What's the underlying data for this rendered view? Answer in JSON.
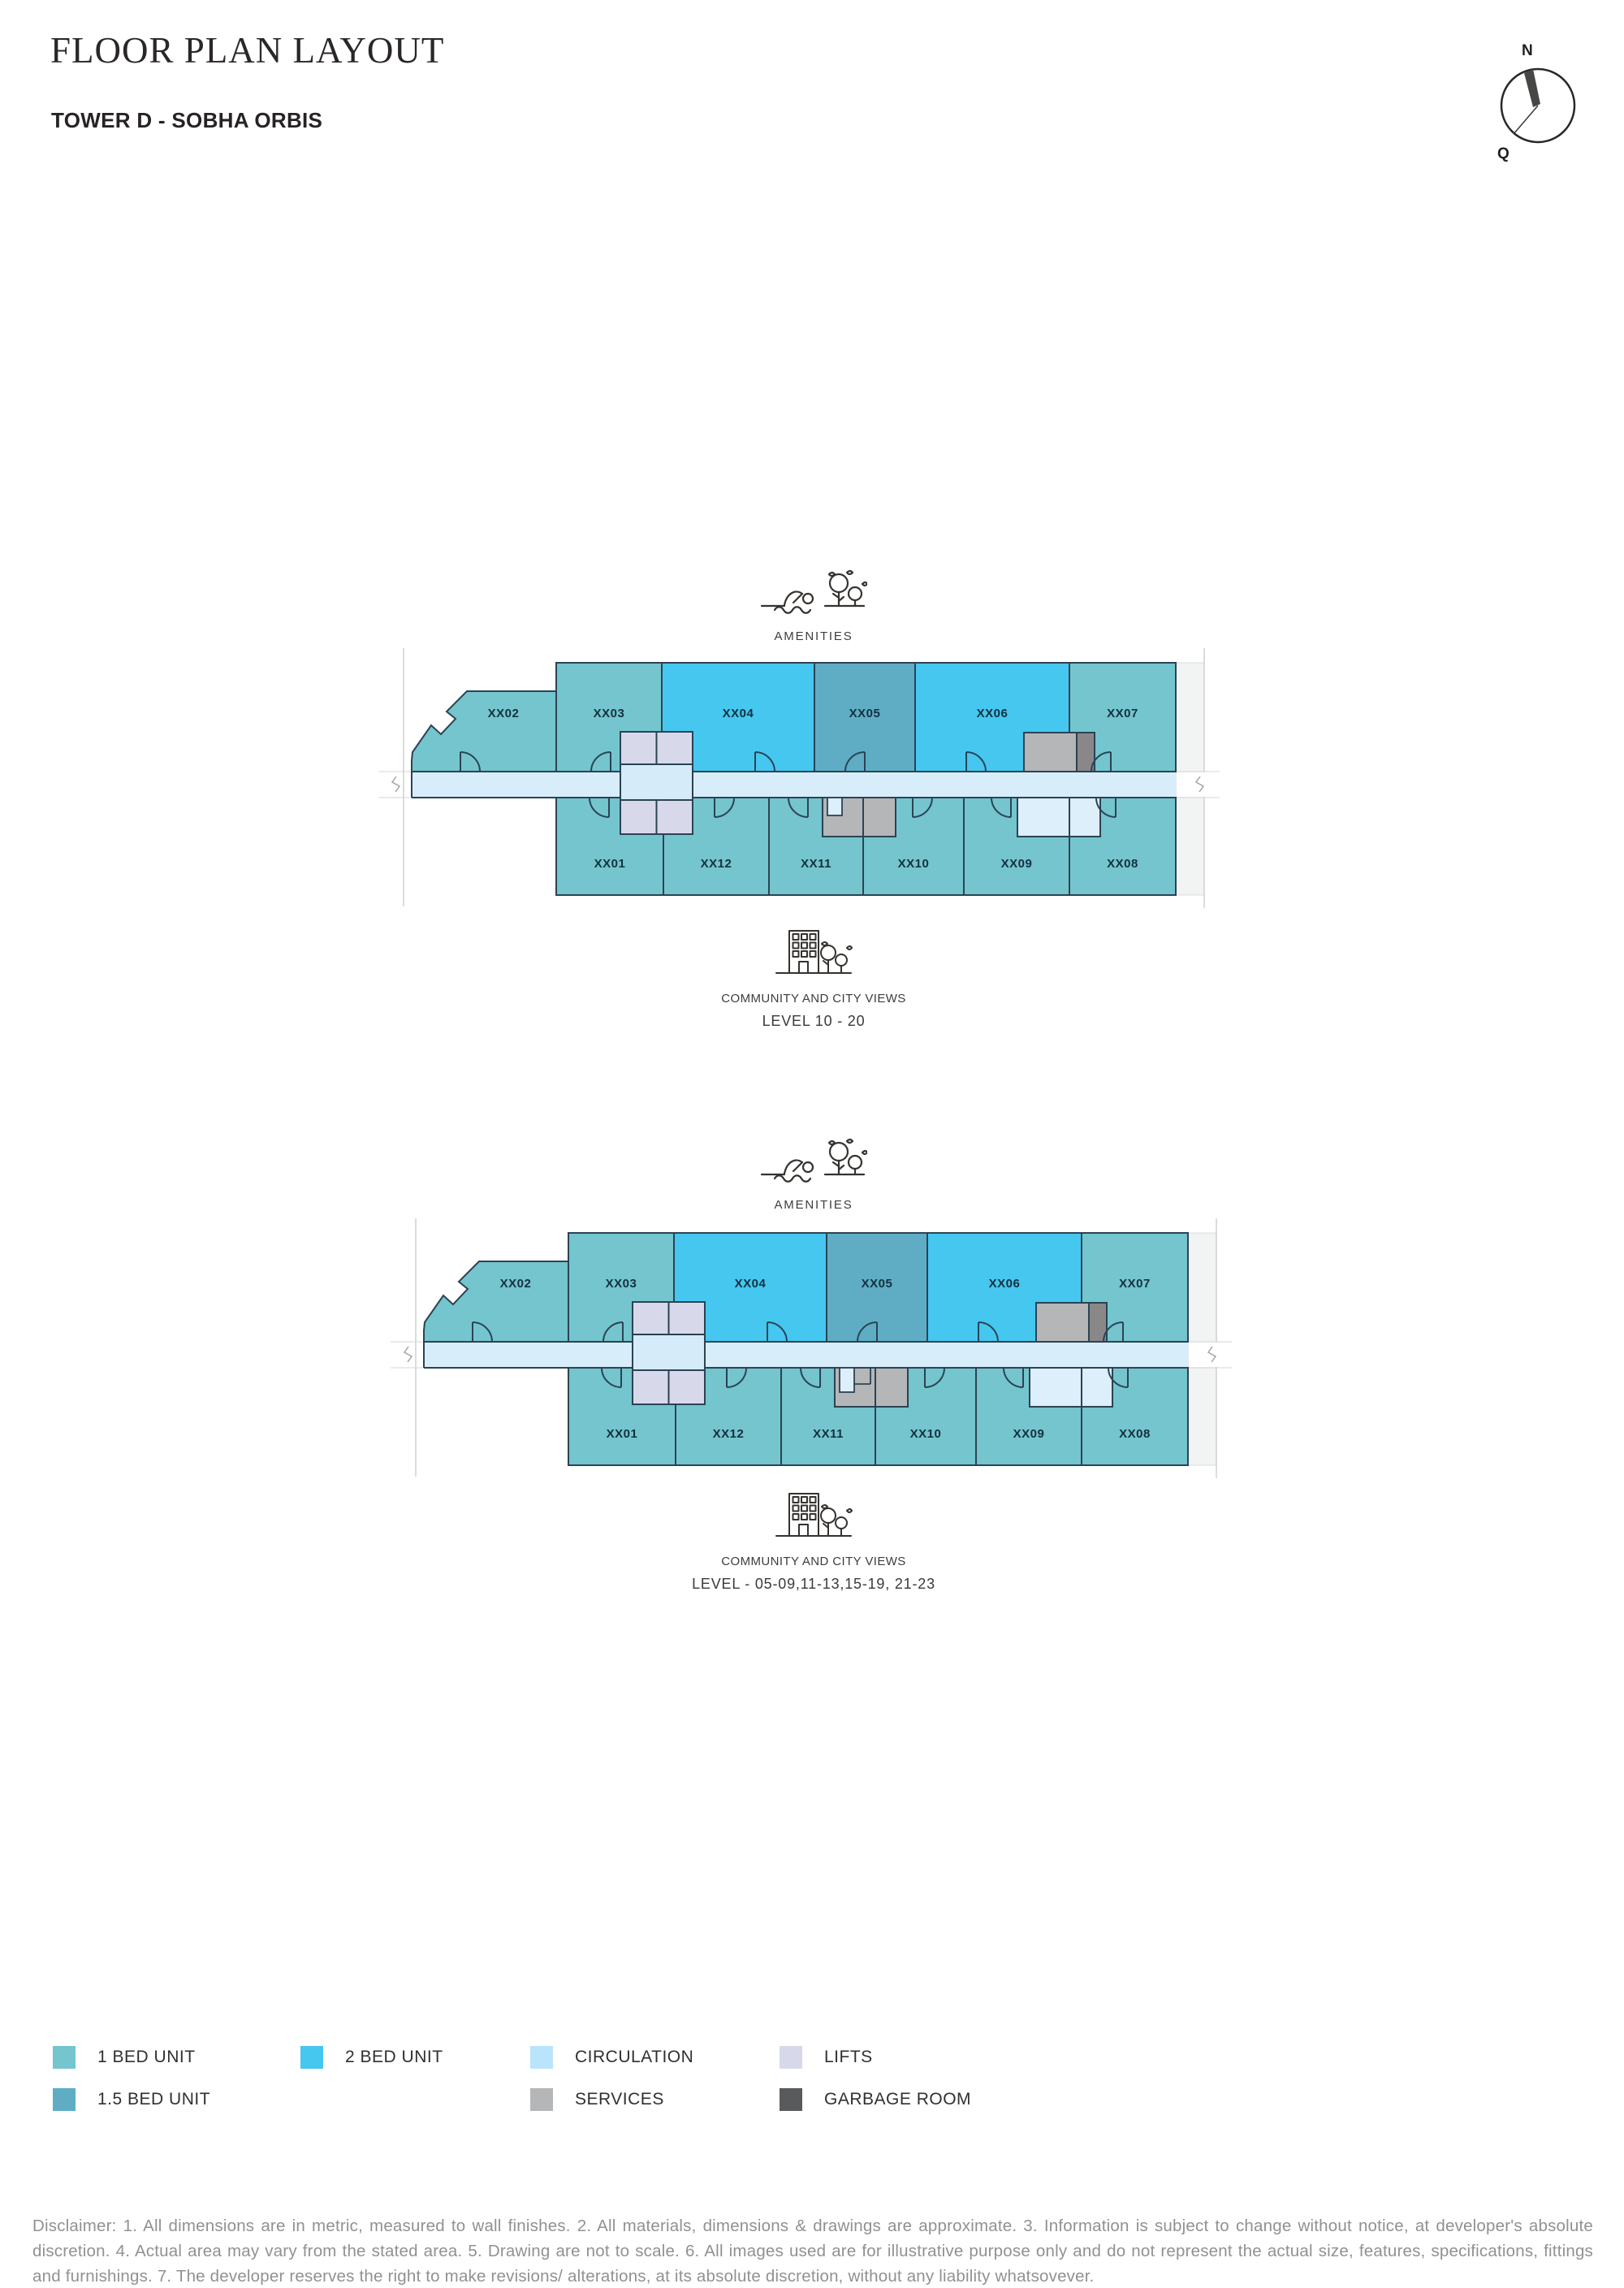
{
  "header": {
    "title": "FLOOR PLAN LAYOUT",
    "subtitle": "TOWER D - SOBHA ORBIS"
  },
  "compass": {
    "north_label": "N",
    "south_label": "Q"
  },
  "plans": [
    {
      "amenities_label": "AMENITIES",
      "community_label": "COMMUNITY AND CITY VIEWS",
      "level_label": "LEVEL 10 - 20",
      "top_units": [
        {
          "label": "XX02",
          "type": "one_bed"
        },
        {
          "label": "XX03",
          "type": "one_bed"
        },
        {
          "label": "XX04",
          "type": "two_bed"
        },
        {
          "label": "XX05",
          "type": "one_half_bed"
        },
        {
          "label": "XX06",
          "type": "two_bed"
        },
        {
          "label": "XX07",
          "type": "one_bed"
        }
      ],
      "bottom_units": [
        {
          "label": "XX01",
          "type": "one_bed"
        },
        {
          "label": "XX12",
          "type": "one_bed"
        },
        {
          "label": "XX11",
          "type": "one_bed"
        },
        {
          "label": "XX10",
          "type": "one_bed"
        },
        {
          "label": "XX09",
          "type": "one_bed"
        },
        {
          "label": "XX08",
          "type": "one_bed"
        }
      ]
    },
    {
      "amenities_label": "AMENITIES",
      "community_label": "COMMUNITY AND CITY VIEWS",
      "level_label": "LEVEL - 05-09,11-13,15-19, 21-23",
      "top_units": [
        {
          "label": "XX02",
          "type": "one_bed"
        },
        {
          "label": "XX03",
          "type": "one_bed"
        },
        {
          "label": "XX04",
          "type": "two_bed"
        },
        {
          "label": "XX05",
          "type": "one_half_bed"
        },
        {
          "label": "XX06",
          "type": "two_bed"
        },
        {
          "label": "XX07",
          "type": "one_bed"
        }
      ],
      "bottom_units": [
        {
          "label": "XX01",
          "type": "one_bed"
        },
        {
          "label": "XX12",
          "type": "one_bed"
        },
        {
          "label": "XX11",
          "type": "one_bed"
        },
        {
          "label": "XX10",
          "type": "one_bed"
        },
        {
          "label": "XX09",
          "type": "one_bed"
        },
        {
          "label": "XX08",
          "type": "one_bed"
        }
      ]
    }
  ],
  "legend": {
    "items": [
      {
        "label": "1 BED UNIT",
        "color_key": "one_bed"
      },
      {
        "label": "2 BED UNIT",
        "color_key": "two_bed"
      },
      {
        "label": "CIRCULATION",
        "color_key": "circulation"
      },
      {
        "label": "LIFTS",
        "color_key": "lifts"
      },
      {
        "label": "1.5 BED UNIT",
        "color_key": "one_half_bed"
      },
      {
        "label": "SERVICES",
        "color_key": "services"
      },
      {
        "label": "GARBAGE ROOM",
        "color_key": "garbage"
      }
    ]
  },
  "colors": {
    "one_bed": "#74c5cd",
    "two_bed": "#45c7ef",
    "one_half_bed": "#5fadc4",
    "circulation": "#b9e4fb",
    "circulation_light": "#ddeffb",
    "corridor": "#d8edfa",
    "lift_lobby": "#d5ebf9",
    "lifts": "#d7d9ea",
    "services": "#b5b6b7",
    "garbage": "#595a5c",
    "garbage_plan": "#8a8788",
    "wall": "#2b4354"
  },
  "disclaimer": "Disclaimer: 1. All dimensions are in metric, measured to wall finishes. 2. All materials, dimensions & drawings are approximate. 3. Information is subject to change without notice, at developer's absolute discretion. 4. Actual area may vary from the stated area. 5. Drawing are not to scale. 6. All images used are for illustrative purpose only and do not represent the actual size, features, specifications, fittings and furnishings. 7. The developer reserves the right to make revisions/ alterations, at its absolute discretion, without any liability whatsovever."
}
